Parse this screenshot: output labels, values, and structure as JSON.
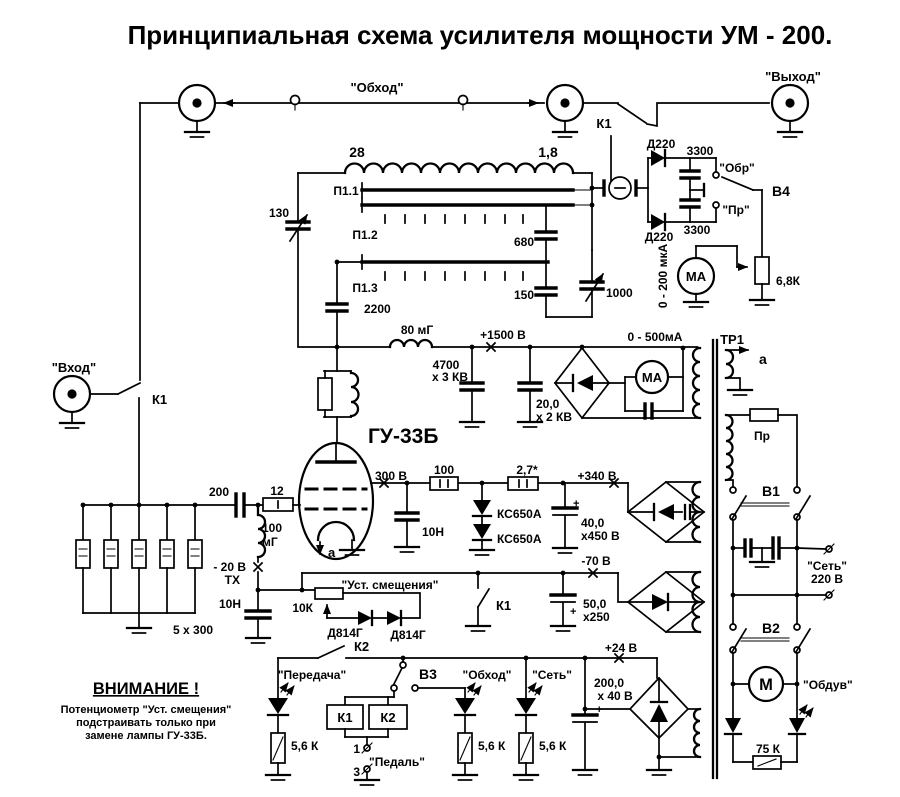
{
  "title": "Принципиальная схема усилителя мощности УМ - 200.",
  "labels": {
    "bypass_top": "\"Обход\"",
    "output": "\"Выход\"",
    "input": "\"Вход\"",
    "k1_antenna": "К1",
    "k1_input": "К1",
    "coil28": "28",
    "coil18": "1,8",
    "p11": "П1.1",
    "p12": "П1.2",
    "p13": "П1.3",
    "c130": "130",
    "c680": "680",
    "c150": "150",
    "c2200": "2200",
    "c1000": "1000",
    "d220_top": "Д220",
    "d220_bot": "Д220",
    "c3300_top": "3300",
    "c3300_bot": "3300",
    "obr": "\"Обр\"",
    "pr_contact": "\"Пр\"",
    "v4": "В4",
    "scale200": "0 - 200 мкА",
    "ma1": "МА",
    "r68k": "6,8К",
    "l80": "80 мГ",
    "v1500": "+1500 В",
    "c4700": "4700",
    "c4700b": "х 3 КВ",
    "c20": "20,0",
    "c20b": "х 2 КВ",
    "scale500": "0 - 500мА",
    "ma2": "МА",
    "tube": "ГУ-33Б",
    "v300": "300 В",
    "r100": "100",
    "r27": "2,7*",
    "v340": "+340 В",
    "ks1": "КС650А",
    "ks2": "КС650А",
    "c10n_screen": "10Н",
    "c40": "40,0",
    "c40b": "х450 В",
    "v70": "-70 В",
    "c200": "200",
    "r12": "12",
    "l100a": "100",
    "l100b": "мГ",
    "v20": "- 20 В",
    "tx": "ТХ",
    "c10n_bias": "10Н",
    "r5x300": "5 х 300",
    "warn_title": "ВНИМАНИЕ !",
    "warn1": "Потенциометр \"Уст. смещения\"",
    "warn2": "подстраивать только при",
    "warn3": "замене лампы ГУ-33Б.",
    "bias_pot": "\"Уст. смещения\"",
    "r10k": "10К",
    "d814_1": "Д814Г",
    "d814_2": "Д814Г",
    "k1_bias": "К1",
    "c50": "50,0",
    "c50b": "х250",
    "k2_contact": "К2",
    "led_tx": "\"Передача\"",
    "v3": "В3",
    "led_bypass": "\"Обход\"",
    "led_net": "\"Сеть\"",
    "relay_k1": "К1",
    "relay_k2": "К2",
    "r56_1": "5,6 К",
    "r56_2": "5,6 К",
    "r56_3": "5,6 К",
    "pin1": "1",
    "pedal": "\"Педаль\"",
    "pin3": "3",
    "v24": "+24 В",
    "c2000": "200,0",
    "c2000b": "х 40 В",
    "plus1": "+",
    "plus2": "+",
    "plus3": "+",
    "tr1": "ТР1",
    "tap_a": "а",
    "tube_a": "а",
    "fuse": "Пр",
    "v1": "В1",
    "net1": "\"Сеть\"",
    "net2": "220 В",
    "v2": "В2",
    "motor": "М",
    "fan": "\"Обдув\"",
    "r75k": "75 К"
  }
}
